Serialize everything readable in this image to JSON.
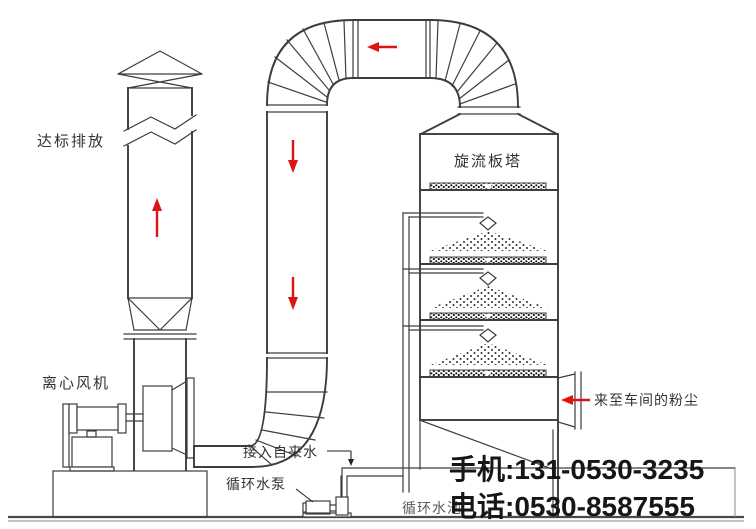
{
  "diagram": {
    "title_hint": "cyclone-plate-tower dust scrubbing system process diagram",
    "labels": {
      "emission": "达标排放",
      "fan": "离心风机",
      "tower": "旋流板塔",
      "tap_water": "接入自来水",
      "pump": "循环水泵",
      "pool": "循环水池",
      "inlet": "来至车间的粉尘"
    },
    "contact": {
      "mobile": "手机:131-0530-3235",
      "phone": "电话:0530-8587555"
    },
    "colors": {
      "line": "#3d3d3d",
      "arrow": "#dd1414",
      "label": "#333333",
      "contact": "#161616"
    }
  }
}
